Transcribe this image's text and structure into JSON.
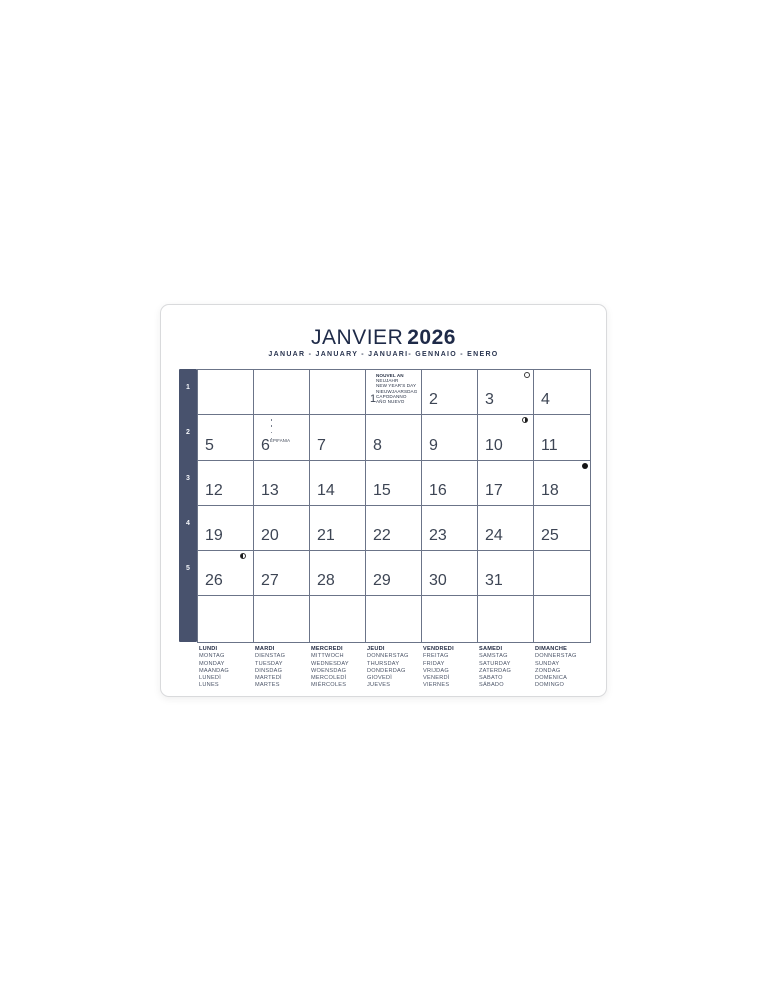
{
  "title": {
    "month": "JANVIER",
    "year": "2026",
    "subtitle": "JANUAR - JANUARY - JANUARI- GENNAIO - ENERO"
  },
  "week_numbers": [
    "1",
    "2",
    "3",
    "4",
    "5"
  ],
  "holiday_jan1": {
    "lines": [
      "NOUVEL AN",
      "NEUJAHR",
      "NEW YEAR'S DAY",
      "NIEUWJAARSDAG",
      "CAPODANNO",
      "AÑO NUEVO"
    ]
  },
  "jan6_note_label": "EPIFANIA",
  "grid_rows": [
    [
      {},
      {},
      {},
      {
        "date": "1",
        "holiday": true
      },
      {
        "date": "2"
      },
      {
        "date": "3",
        "moon": "full"
      },
      {
        "date": "4"
      }
    ],
    [
      {
        "date": "5"
      },
      {
        "date": "6",
        "note": true
      },
      {
        "date": "7"
      },
      {
        "date": "8"
      },
      {
        "date": "9"
      },
      {
        "date": "10",
        "moon": "last_quarter"
      },
      {
        "date": "11"
      }
    ],
    [
      {
        "date": "12"
      },
      {
        "date": "13"
      },
      {
        "date": "14"
      },
      {
        "date": "15"
      },
      {
        "date": "16"
      },
      {
        "date": "17"
      },
      {
        "date": "18",
        "moon": "new"
      }
    ],
    [
      {
        "date": "19"
      },
      {
        "date": "20"
      },
      {
        "date": "21"
      },
      {
        "date": "22"
      },
      {
        "date": "23"
      },
      {
        "date": "24"
      },
      {
        "date": "25"
      }
    ],
    [
      {
        "date": "26",
        "moon": "first_quarter"
      },
      {
        "date": "27"
      },
      {
        "date": "28"
      },
      {
        "date": "29"
      },
      {
        "date": "30"
      },
      {
        "date": "31"
      },
      {}
    ],
    [
      {},
      {},
      {},
      {},
      {},
      {},
      {}
    ]
  ],
  "moon_legend": [
    {
      "day": "3",
      "phase": "full"
    },
    {
      "day": "10",
      "phase": "last_quarter"
    },
    {
      "day": "18",
      "phase": "new"
    },
    {
      "day": "26",
      "phase": "first_quarter"
    }
  ],
  "footer_columns": [
    {
      "lines": [
        "LUNDI",
        "MONTAG",
        "MONDAY",
        "MAANDAG",
        "LUNEDÌ",
        "LUNES"
      ]
    },
    {
      "lines": [
        "MARDI",
        "DIENSTAG",
        "TUESDAY",
        "DINSDAG",
        "MARTEDÌ",
        "MARTES"
      ]
    },
    {
      "lines": [
        "MERCREDI",
        "MITTWOCH",
        "WEDNESDAY",
        "WOENSDAG",
        "MERCOLEDÌ",
        "MIÉRCOLES"
      ]
    },
    {
      "lines": [
        "JEUDI",
        "DONNERSTAG",
        "THURSDAY",
        "DONDERDAG",
        "GIOVEDÌ",
        "JUEVES"
      ]
    },
    {
      "lines": [
        "VENDREDI",
        "FREITAG",
        "FRIDAY",
        "VRIJDAG",
        "VENERDÌ",
        "VIERNES"
      ]
    },
    {
      "lines": [
        "SAMEDI",
        "SAMSTAG",
        "SATURDAY",
        "ZATERDAG",
        "SABATO",
        "SÁBADO"
      ]
    },
    {
      "lines": [
        "DIMANCHE",
        "DONNERSTAG",
        "SUNDAY",
        "ZONDAG",
        "DOMENICA",
        "DOMINGO"
      ]
    }
  ],
  "colors": {
    "navy": "#1e2a48",
    "line": "#6b7488",
    "weekcol": "#48526d",
    "date": "#3d4554"
  }
}
